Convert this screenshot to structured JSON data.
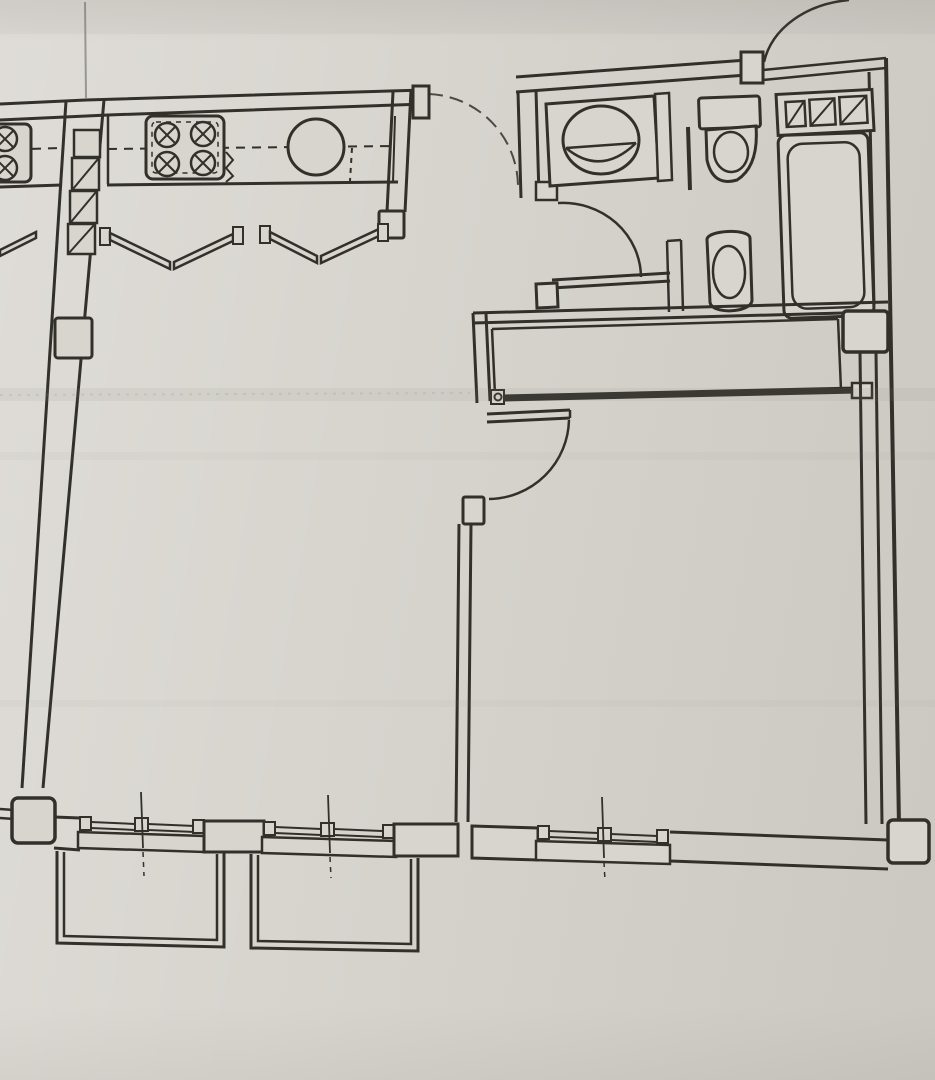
{
  "document": {
    "kind": "scanned-floor-plan-photo",
    "visible_text": "none",
    "notes": "architectural apartment floor plan, slightly skewed photograph, no dimensions or labels printed"
  },
  "palette": {
    "paper": "#d8d5cf",
    "paper_light": "#dfdcd6",
    "paper_dark": "#cfccc5",
    "ink": "#32302b",
    "crease": "#8a867e"
  },
  "plan": {
    "rooms": [
      {
        "name": "kitchen",
        "fixtures": [
          "stove-4-burner",
          "round-sink",
          "counter",
          "bifold-doors-x2"
        ]
      },
      {
        "name": "neighbor-kitchen-partial",
        "fixtures": [
          "stove-partial"
        ]
      },
      {
        "name": "entry-hall",
        "fixtures": [
          "entrance-door-arc"
        ]
      },
      {
        "name": "bathroom",
        "fixtures": [
          "washbasin-oval",
          "toilet-with-tank",
          "toilet-second",
          "bathtub",
          "vent-shaft-3-hatched",
          "bath-door-arc"
        ]
      },
      {
        "name": "closet",
        "fixtures": [
          "sliding-door-track",
          "corner-column"
        ]
      },
      {
        "name": "living-room",
        "fixtures": [
          "window",
          "window",
          "balcony",
          "balcony",
          "corner-column"
        ]
      },
      {
        "name": "bedroom",
        "fixtures": [
          "door-arc",
          "window",
          "corner-column"
        ]
      }
    ],
    "counts": {
      "burners": 4,
      "vent_hatch_squares": 3,
      "duct_hatch_squares": 3,
      "windows": 3,
      "balconies": 2,
      "door_arcs": 5
    }
  }
}
